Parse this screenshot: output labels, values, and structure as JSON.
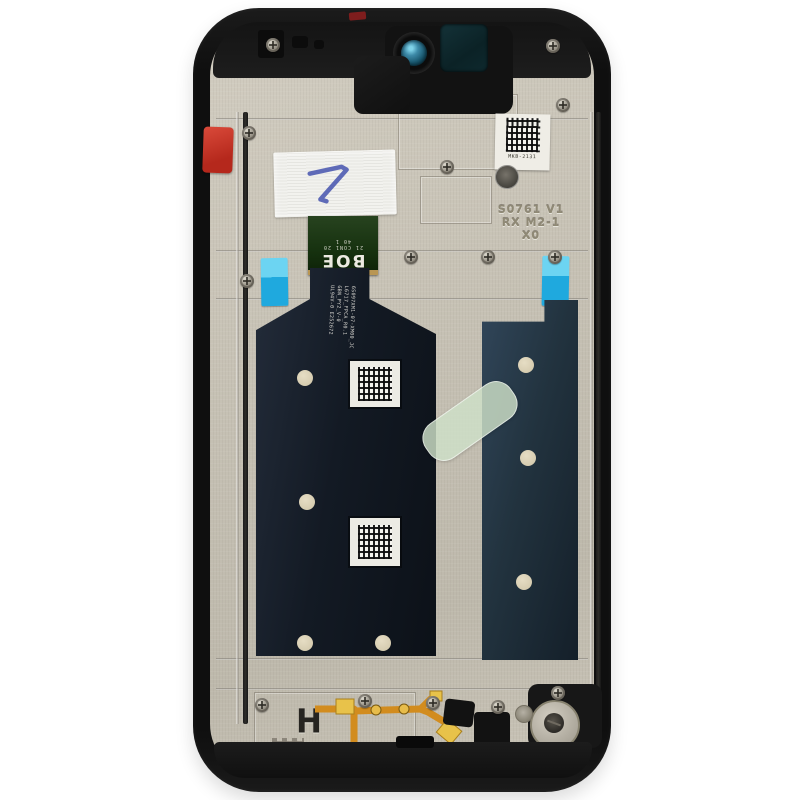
{
  "photo": {
    "subject": "Smartphone LCD display assembly with frame, rear view on white background",
    "background_color": "#ffffff"
  },
  "markings": {
    "boe_logo": "BOE",
    "connector_pins_row1": "21 CON1 20",
    "connector_pins_row2": "40      1",
    "stamp_line1": "S0761 V1",
    "stamp_line2": "RX M2-1",
    "stamp_line3": "X0",
    "qr_caption": "MKB-2131",
    "handwritten_mark": "7",
    "flex_print_line1": "6S097XM1-07-XM00_JC",
    "flex_print_line2": "L6717_FPCA_R0.1",
    "flex_print_line3": "GBN_PY2_V-0",
    "flex_print_line4": "UL94V-0 E252672",
    "frame_letter": "H"
  },
  "colors": {
    "frame_black": "#121212",
    "backplate_beige": "#c7c2b5",
    "lcd_teal": "#22333f",
    "flex_navy": "#131a24",
    "connector_green": "#1d3a16",
    "cyan_tape": "#1fa9de",
    "green_tape": "#cee0c8",
    "orange_flex": "#d28c1e",
    "red_tab": "#c0392b",
    "ink_blue": "#4553ae"
  }
}
